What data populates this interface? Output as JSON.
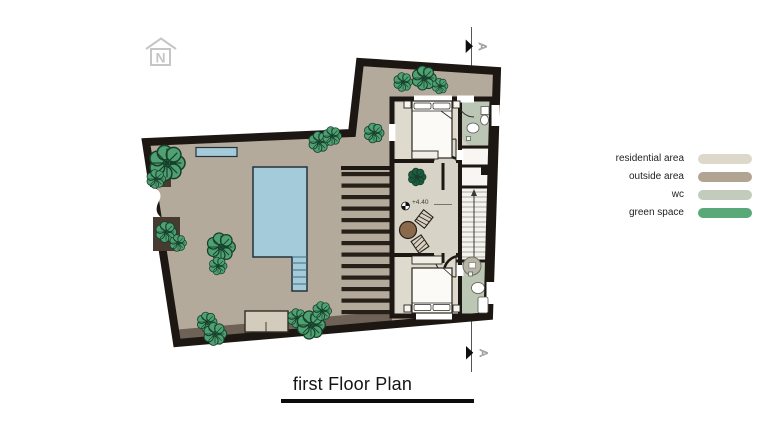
{
  "title": {
    "text": "first Floor Plan"
  },
  "north_indicator": {
    "letter": "N"
  },
  "section_marker": {
    "letter": "A"
  },
  "plan": {
    "level_label": "+4.40"
  },
  "legend": {
    "items": [
      {
        "label": "residential area",
        "color": "#dcd9ca"
      },
      {
        "label": "outside area",
        "color": "#b1a493"
      },
      {
        "label": "wc",
        "color": "#c3cbbc"
      },
      {
        "label": "green space",
        "color": "#58a878"
      }
    ]
  },
  "theme": {
    "wall": "#1c1712",
    "outside": "#b4aa9b",
    "resid": "#d7d3c6",
    "wc": "#bcc6b5",
    "green": "#4fa173",
    "greendark": "#1d5c3e",
    "pool": "#a4cbd9",
    "poolline": "#3f6d80",
    "band": "#6e6156",
    "planter": "#473b30",
    "louver": "#262019",
    "brown": "#8a6a4a",
    "muted": "#c6c6c6",
    "linegray": "#555555"
  }
}
